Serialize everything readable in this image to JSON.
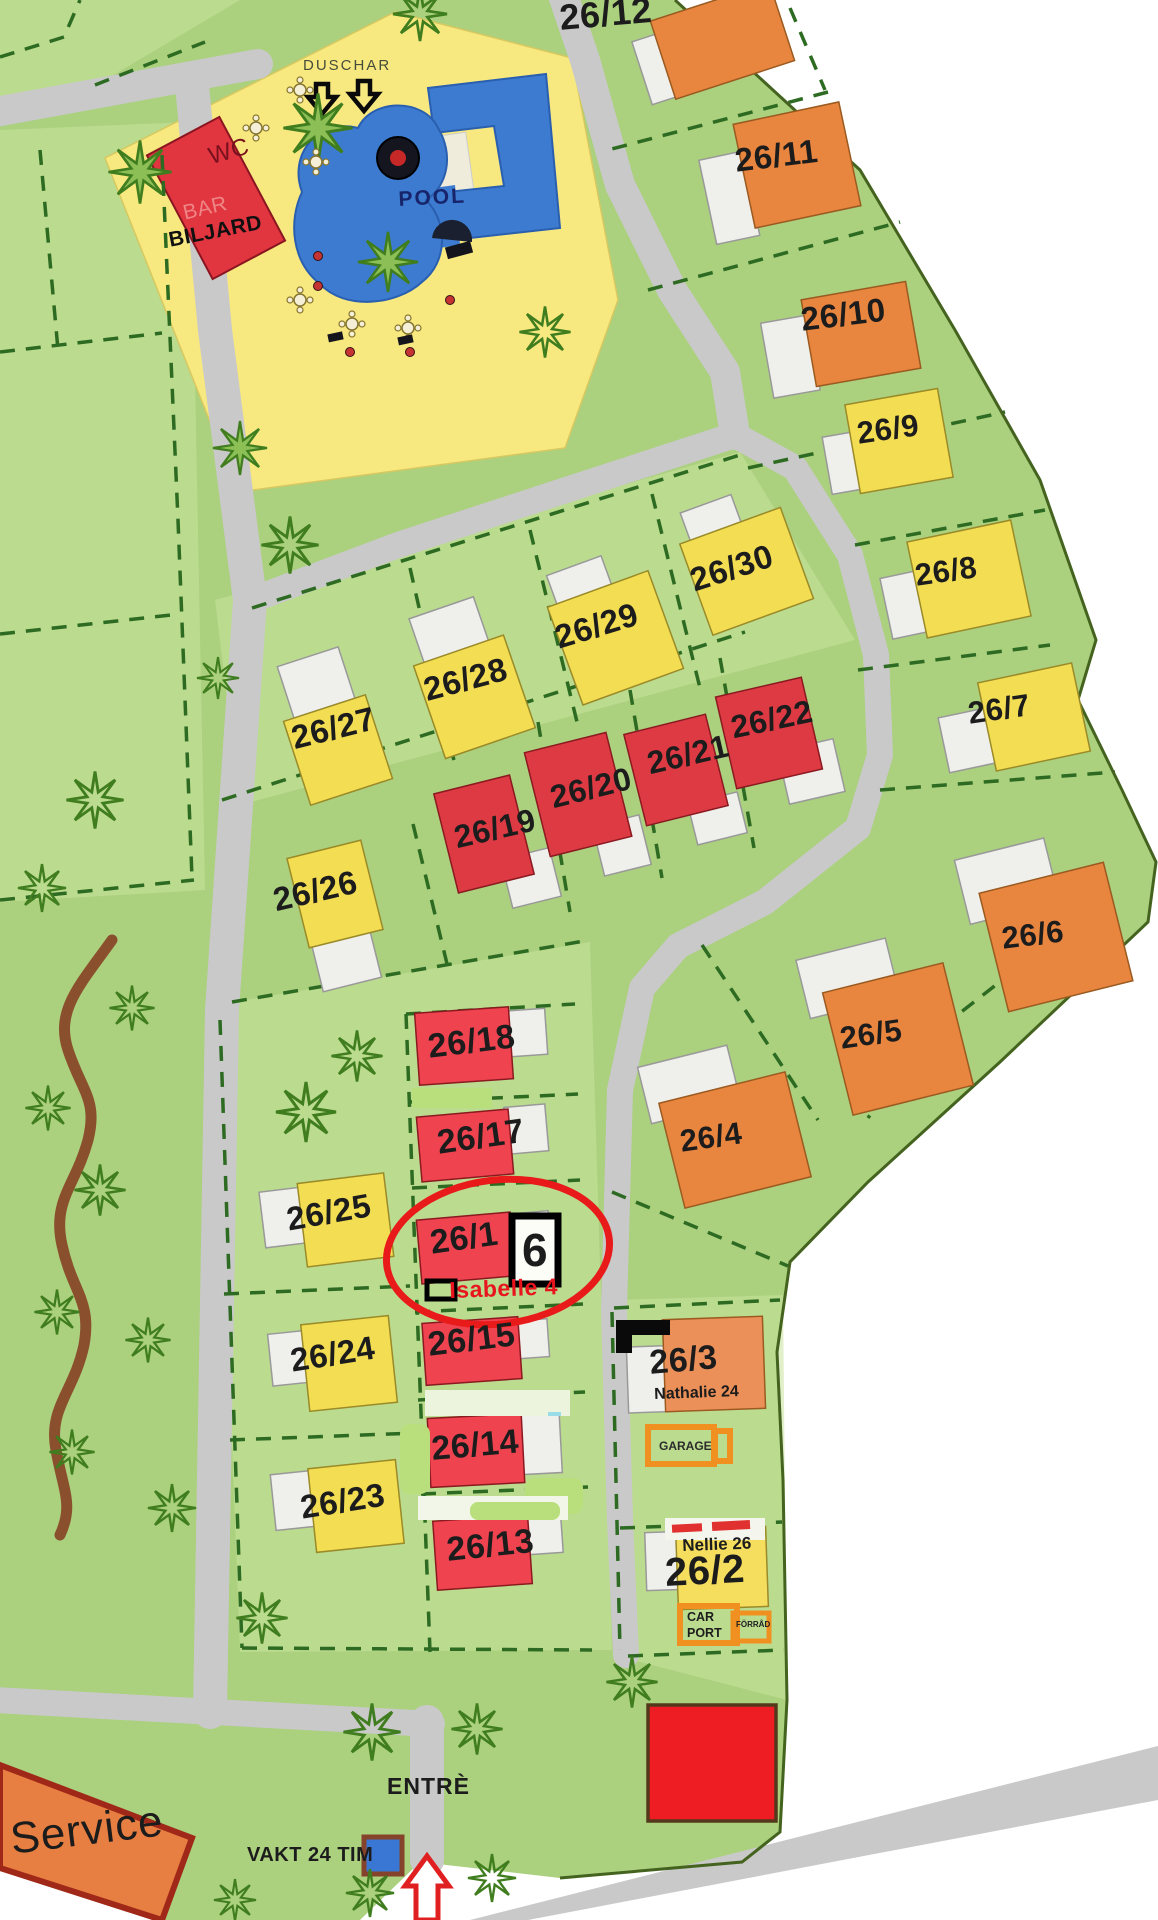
{
  "map": {
    "pool_area": {
      "duschar": "DUSCHAR",
      "pool": "POOL",
      "wc": "WC",
      "bar": "BAR",
      "biljard": "BILJARD"
    },
    "lots": {
      "l12": "26/12",
      "l11": "26/11",
      "l10": "26/10",
      "l9": "26/9",
      "l8": "26/8",
      "l7": "26/7",
      "l6": "26/6",
      "l5": "26/5",
      "l4": "26/4",
      "l30": "26/30",
      "l29": "26/29",
      "l28": "26/28",
      "l27": "26/27",
      "l26": "26/26",
      "l25": "26/25",
      "l24": "26/24",
      "l23": "26/23",
      "l22": "26/22",
      "l21": "26/21",
      "l20": "26/20",
      "l19": "26/19",
      "l18": "26/18",
      "l17": "26/17",
      "l16": "26/1",
      "l15": "26/15",
      "l14": "26/14",
      "l13": "26/13",
      "l3": "26/3",
      "l2": "26/2"
    },
    "circled_lot": {
      "box_digit": "6",
      "name_tag": "Isabelle 4"
    },
    "tags": {
      "nathalie": "Nathalie 24",
      "garage": "GARAGE",
      "nellie": "Nellie 26",
      "car": "CAR",
      "port": "PORT",
      "forrad": "FÖRRÅD"
    },
    "bottom": {
      "entrance": "ENTRÈ",
      "guard": "VAKT 24 TIM",
      "service": "Service"
    },
    "colors": {
      "map_green": "#abd07e",
      "pool_yellow": "#f7e97f",
      "pool_blue": "#3c7bd0",
      "road_gray": "#c9c9c9",
      "house_orange": "#e8853f",
      "house_yellow": "#f3dd52",
      "house_red": "#e6404a",
      "highlight_red": "#e81a1a",
      "annotation_orange": "#f09020"
    }
  }
}
